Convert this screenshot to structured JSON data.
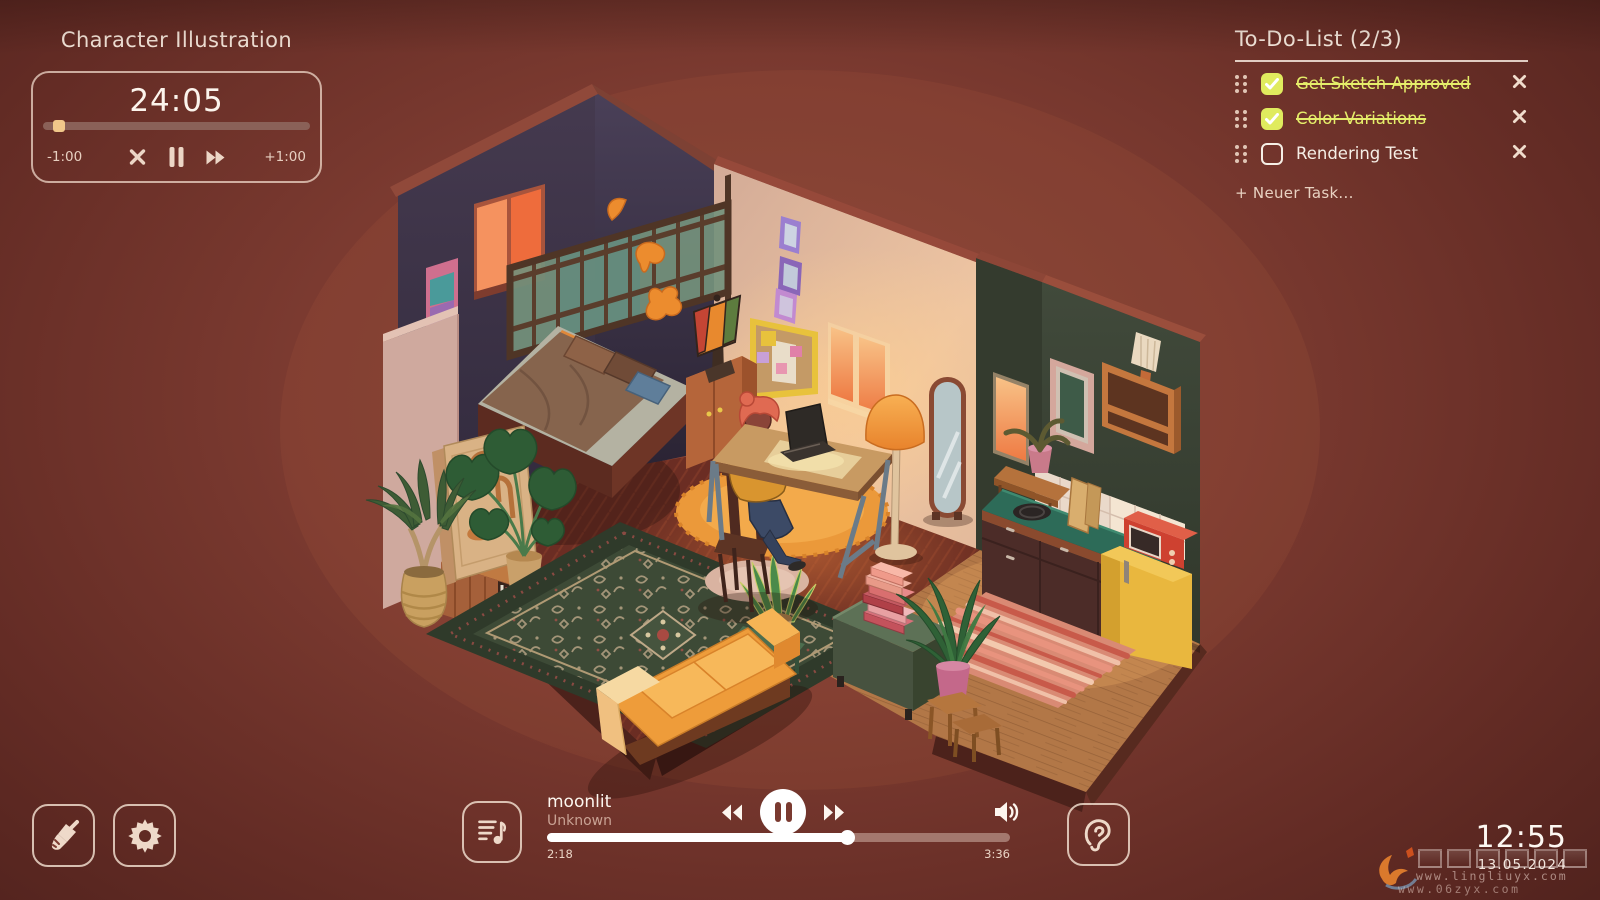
{
  "session": {
    "title": "Character Illustration",
    "time_remaining": "24:05",
    "subtract_label": "-1:00",
    "add_label": "+1:00",
    "progress_pct": 4
  },
  "todo": {
    "title": "To-Do-List",
    "count": "(2/3)",
    "items": [
      {
        "label": "Get Sketch Approved",
        "done": true
      },
      {
        "label": "Color Variations",
        "done": true
      },
      {
        "label": "Rendering Test",
        "done": false
      }
    ],
    "add_task_label": "+ Neuer Task...",
    "accent_color": "#e5ee6a"
  },
  "player": {
    "track_title": "moonlit",
    "artist": "Unknown",
    "elapsed": "2:18",
    "duration": "3:36",
    "progress_pct": 65
  },
  "clock": {
    "time": "12:55",
    "date": "13.05.2024"
  },
  "watermark": {
    "line1": "www.lingliuyx.com",
    "line2": "www.06zyx.com"
  },
  "icons": {
    "timer_cancel": "x-cross",
    "timer_pause": "pause-bars",
    "timer_skip": "fast-forward",
    "drag_handle": "six-dots",
    "task_remove": "x-cross",
    "theme_brush": "paint-brush",
    "settings": "gear",
    "ambient_sounds": "ear",
    "playlist": "music-note-list",
    "rewind": "double-triangle-left",
    "play_pause": "pause-circle",
    "fast_forward": "double-triangle-right",
    "volume": "speaker-waves"
  },
  "colors": {
    "background": "#7b3a30",
    "cream": "#f2e2d4",
    "accent_yellow": "#e5ee6a",
    "window_glow": "#f08048"
  },
  "scene": {
    "description": "Isometric cozy night room: dark-purple loft corner with glowing orange window and wooden lattice over a bed, cream wall with pinboard and lit window, person with pink hair working on a laptop at a desk, orange floor lamp, standing mirror, dark-green kitchen corner with teal counter, yellow fridge and red microwave, green chest with stacked pink books, many plants, ornate dark-green rug, orange sofa and round orange rug."
  }
}
